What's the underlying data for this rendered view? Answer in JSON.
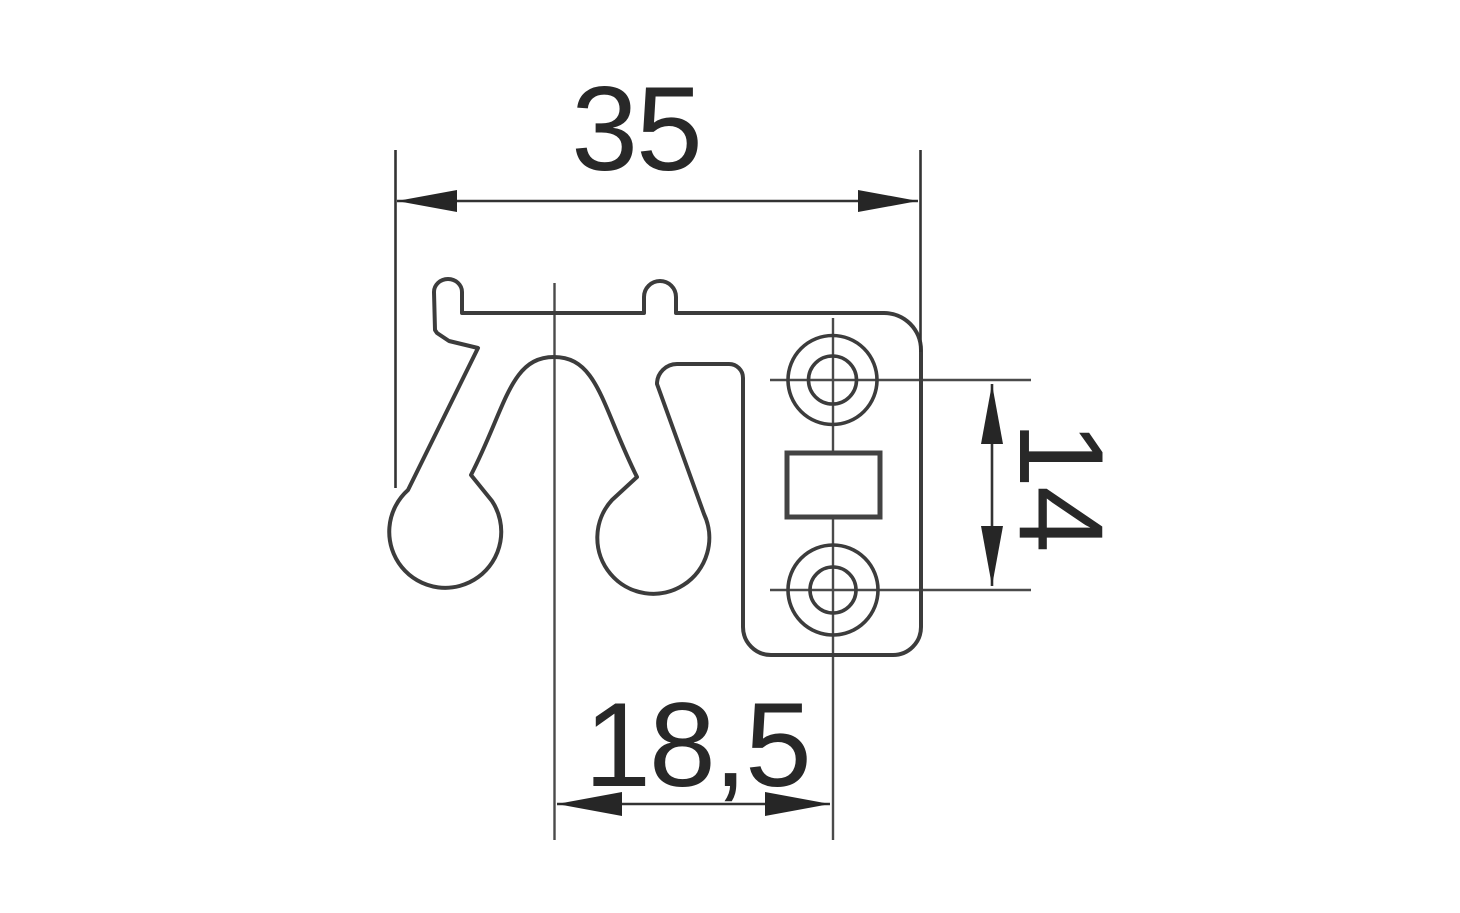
{
  "drawing": {
    "kind": "technical-drawing-profile-cross-section",
    "background_color": "#ffffff",
    "outline_color": "#3c3c3c",
    "dimension_color": "#282828",
    "dimensions": {
      "overall_width": "35",
      "hole_spacing": "14",
      "center_offset": "18,5"
    }
  }
}
